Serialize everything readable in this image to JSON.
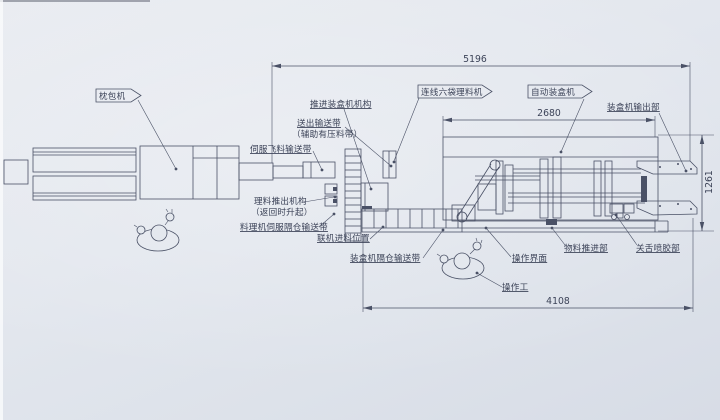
{
  "flags": {
    "pillow_packer": "枕包机",
    "inline_arranger": "连线六袋理料机",
    "auto_cartoner": "自动装盒机"
  },
  "labels": {
    "push_mechanism": "推进装盒机机构",
    "outfeed_belt": "送出输送带",
    "outfeed_belt_note": "（辅助有压料带）",
    "servo_fly_belt": "伺服飞料输送带",
    "pushout_mechanism": "理料推出机构",
    "pushout_note": "（返回时升起）",
    "servo_compartment_belt": "料理机伺服隔仓输送带",
    "inline_infeed_position": "联机进料位置",
    "cartoner_compartment_belt": "装盒机隔仓输送带",
    "cartoner_output": "装盒机输出部",
    "operation_interface": "操作界面",
    "material_pusher": "物料推进部",
    "tongue_glue_unit": "关舌喷胶部",
    "operator": "操作工"
  },
  "dimensions": {
    "overall_length": "5196",
    "cartoner_length": "2680",
    "line_length": "4108",
    "machine_width": "1261"
  },
  "colors": {
    "paper": "#e3e7ee",
    "line": "#4a5166",
    "text": "#3c4358"
  }
}
